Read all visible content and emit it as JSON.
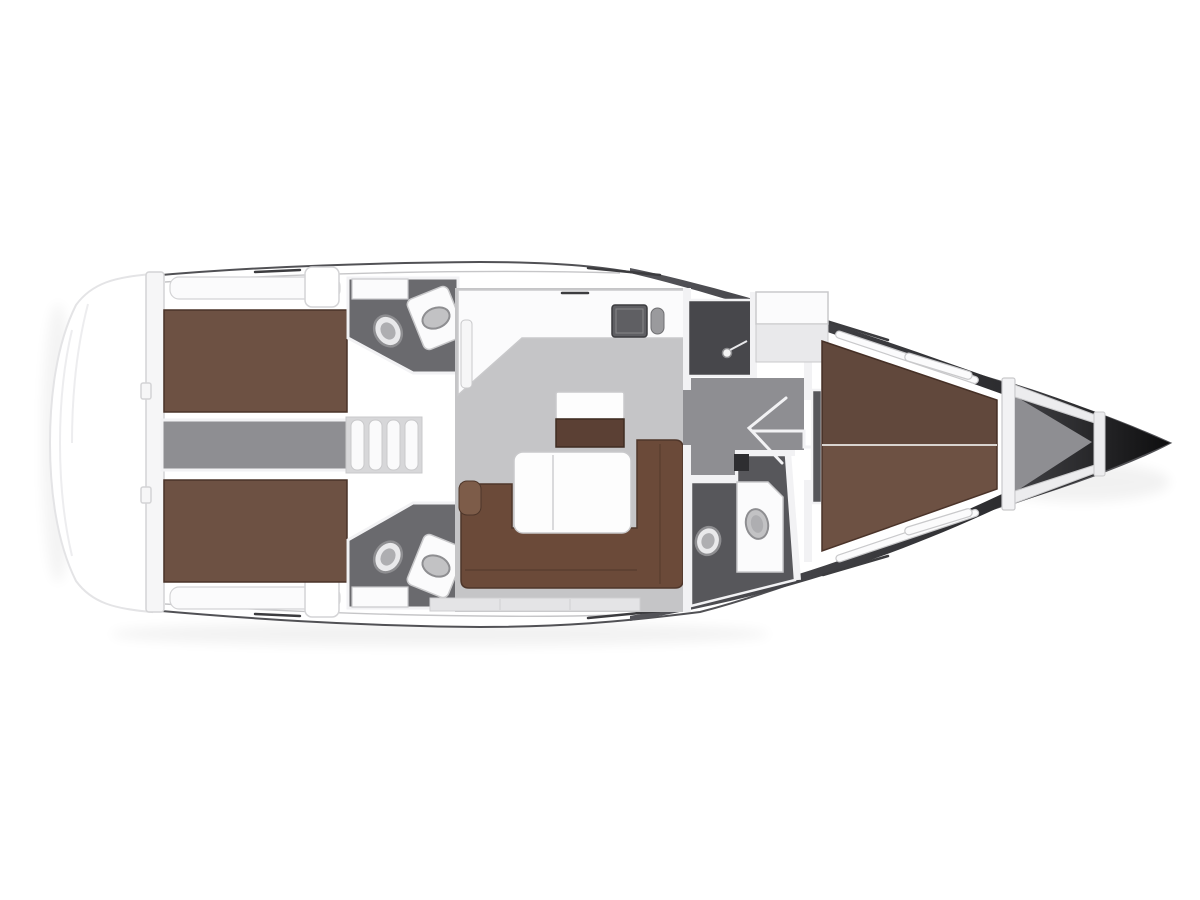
{
  "colors": {
    "background": "#ffffff",
    "hull_outline": "#515155",
    "hull_dark_start": "#55555a",
    "hull_dark_end": "#1a1a1c",
    "bow_dark_start": "#454549",
    "bow_dark_end": "#0d0d0e",
    "platform_edge": "#e4e4e6",
    "platform_arc": "#ededef",
    "transom_fill": "#f6f6f7",
    "deck_trim": "#d4d4d6",
    "toe_line": "#c6c6c8",
    "track_dark": "#3c3c3f",
    "band_fill": "#fbfbfc",
    "bed_brown": "#6d5143",
    "bed_edge": "#4a3329",
    "bed_shade": "rgba(0,0,0,0.10)",
    "seam_light": "#d9d4d0",
    "floor_light": "#c5c5c7",
    "floor_mid": "#8e8e92",
    "floor_dark": "#57575b",
    "head_floor": "#6a6a6e",
    "shower_dark": "#47474b",
    "steps_fill": "#d7d7d9",
    "step_rib": "#fafafb",
    "wall_white": "#f2f2f4",
    "line_gray": "#c9c9cb",
    "counter_white": "#fbfbfc",
    "fixture_white": "#e9e9eb",
    "fixture_inner": "#aeaeb1",
    "fixture_rim": "#8e8e91",
    "sink_dark": "#5f5f63",
    "sink_oval": "#c2c2c4",
    "table_white": "#fdfdfd",
    "table_seam": "#dadadc",
    "cabinet_brown": "#5b4034",
    "cabinet_edge": "#3f2c22",
    "sofa_brown": "#6b4a39",
    "sofa_edge": "#4e362a",
    "sofa_accent": "#7d5c49",
    "beam_fill": "#ececee"
  },
  "icons": {
    "toilet": "oval-bowl-with-rim",
    "sink": "oval-basin-on-counter",
    "shower_head": "circle-with-hose",
    "galley_sink": "dark-rect-basin",
    "companionway_steps": "ribbed-stairs",
    "door_swing": "open-chevron"
  }
}
